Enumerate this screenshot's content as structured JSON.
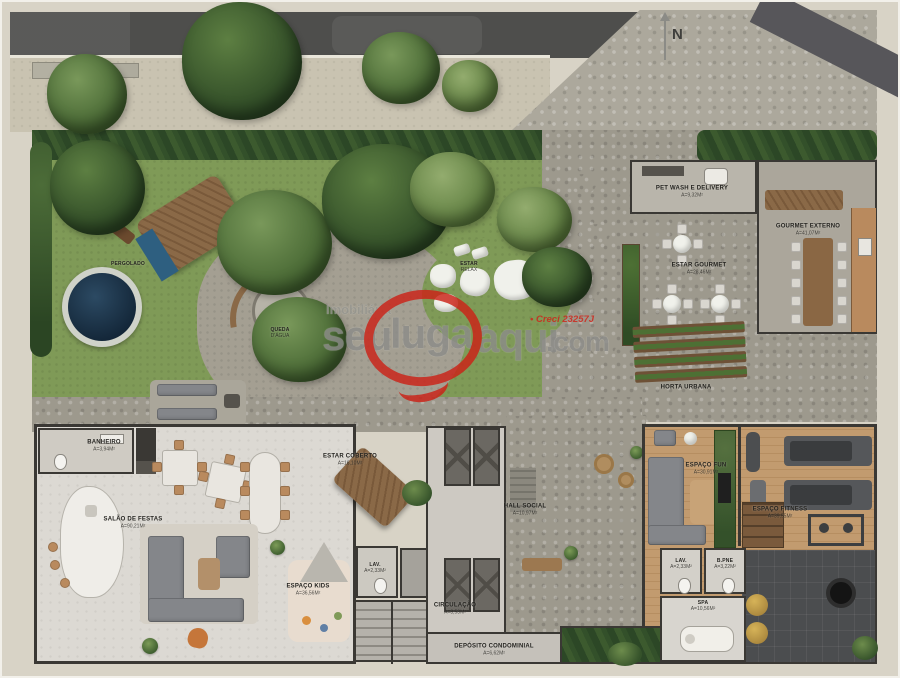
{
  "site": {
    "compass_n": "N",
    "plan_type": "ground-floor landscape implantation plan"
  },
  "watermark": {
    "brand_prefix": "Imobiliária",
    "word1": "seu",
    "word2": "lugar",
    "word3": "aqui",
    "suffix": ".com",
    "creci": "• Creci 23257J",
    "accent_red": "#cc2217",
    "text_gray": "#8c8c89"
  },
  "areas": {
    "pergolado": {
      "name": "PERGOLADO"
    },
    "queda_dagua": {
      "name": "QUEDA",
      "name2": "D'ÁGUA"
    },
    "estar_relax": {
      "name": "ESTAR",
      "name2": "RELAX"
    },
    "pet_wash": {
      "name": "PET WASH E DELIVERY",
      "area": "A=9,32m²"
    },
    "estar_gourmet": {
      "name": "ESTAR GOURMET",
      "area": "A=28,46m²"
    },
    "gourmet_externo": {
      "name": "GOURMET EXTERNO",
      "area": "A=41,07m²"
    },
    "horta_urbana": {
      "name": "HORTA URBANA"
    },
    "banheiro": {
      "name": "BANHEIRO",
      "area": "A=3,94m²"
    },
    "salao_festas": {
      "name": "SALÃO DE FESTAS",
      "area": "A=90,21m²"
    },
    "estar_coberto": {
      "name": "ESTAR COBERTO",
      "area": "A=16,10m²"
    },
    "hall_social": {
      "name": "HALL SOCIAL",
      "area": "A=10,97m²"
    },
    "espaco_kids": {
      "name": "ESPAÇO KIDS",
      "area": "A=36,56m²"
    },
    "lavabo_1": {
      "name": "LAV.",
      "area": "A=2,33m²"
    },
    "circulacao": {
      "name": "CIRCULAÇÃO",
      "area": "A=8,53m²"
    },
    "deposito": {
      "name": "DEPÓSITO CONDOMINIAL",
      "area": "A=6,62m²"
    },
    "espaco_fun": {
      "name": "ESPAÇO FUN",
      "area": "A=30,91m²"
    },
    "espaco_fitness": {
      "name": "ESPAÇO FITNESS",
      "area": "A=39,55m²"
    },
    "lavabo_2": {
      "name": "LAV.",
      "area": "A=2,33m²"
    },
    "banheiro_pne": {
      "name": "B.PNE",
      "area": "A=3,22m²"
    },
    "spa": {
      "name": "SPA",
      "area": "A=10,56m²"
    }
  },
  "colors": {
    "background_beige": "#d8d3c6",
    "asphalt": "#4e4e4c",
    "grass": "#7f9a57",
    "stone_paving": "#9d998d",
    "pool_water": "#1d3850",
    "wood_floor": "#c29b6f",
    "wall": "#3a3834"
  }
}
